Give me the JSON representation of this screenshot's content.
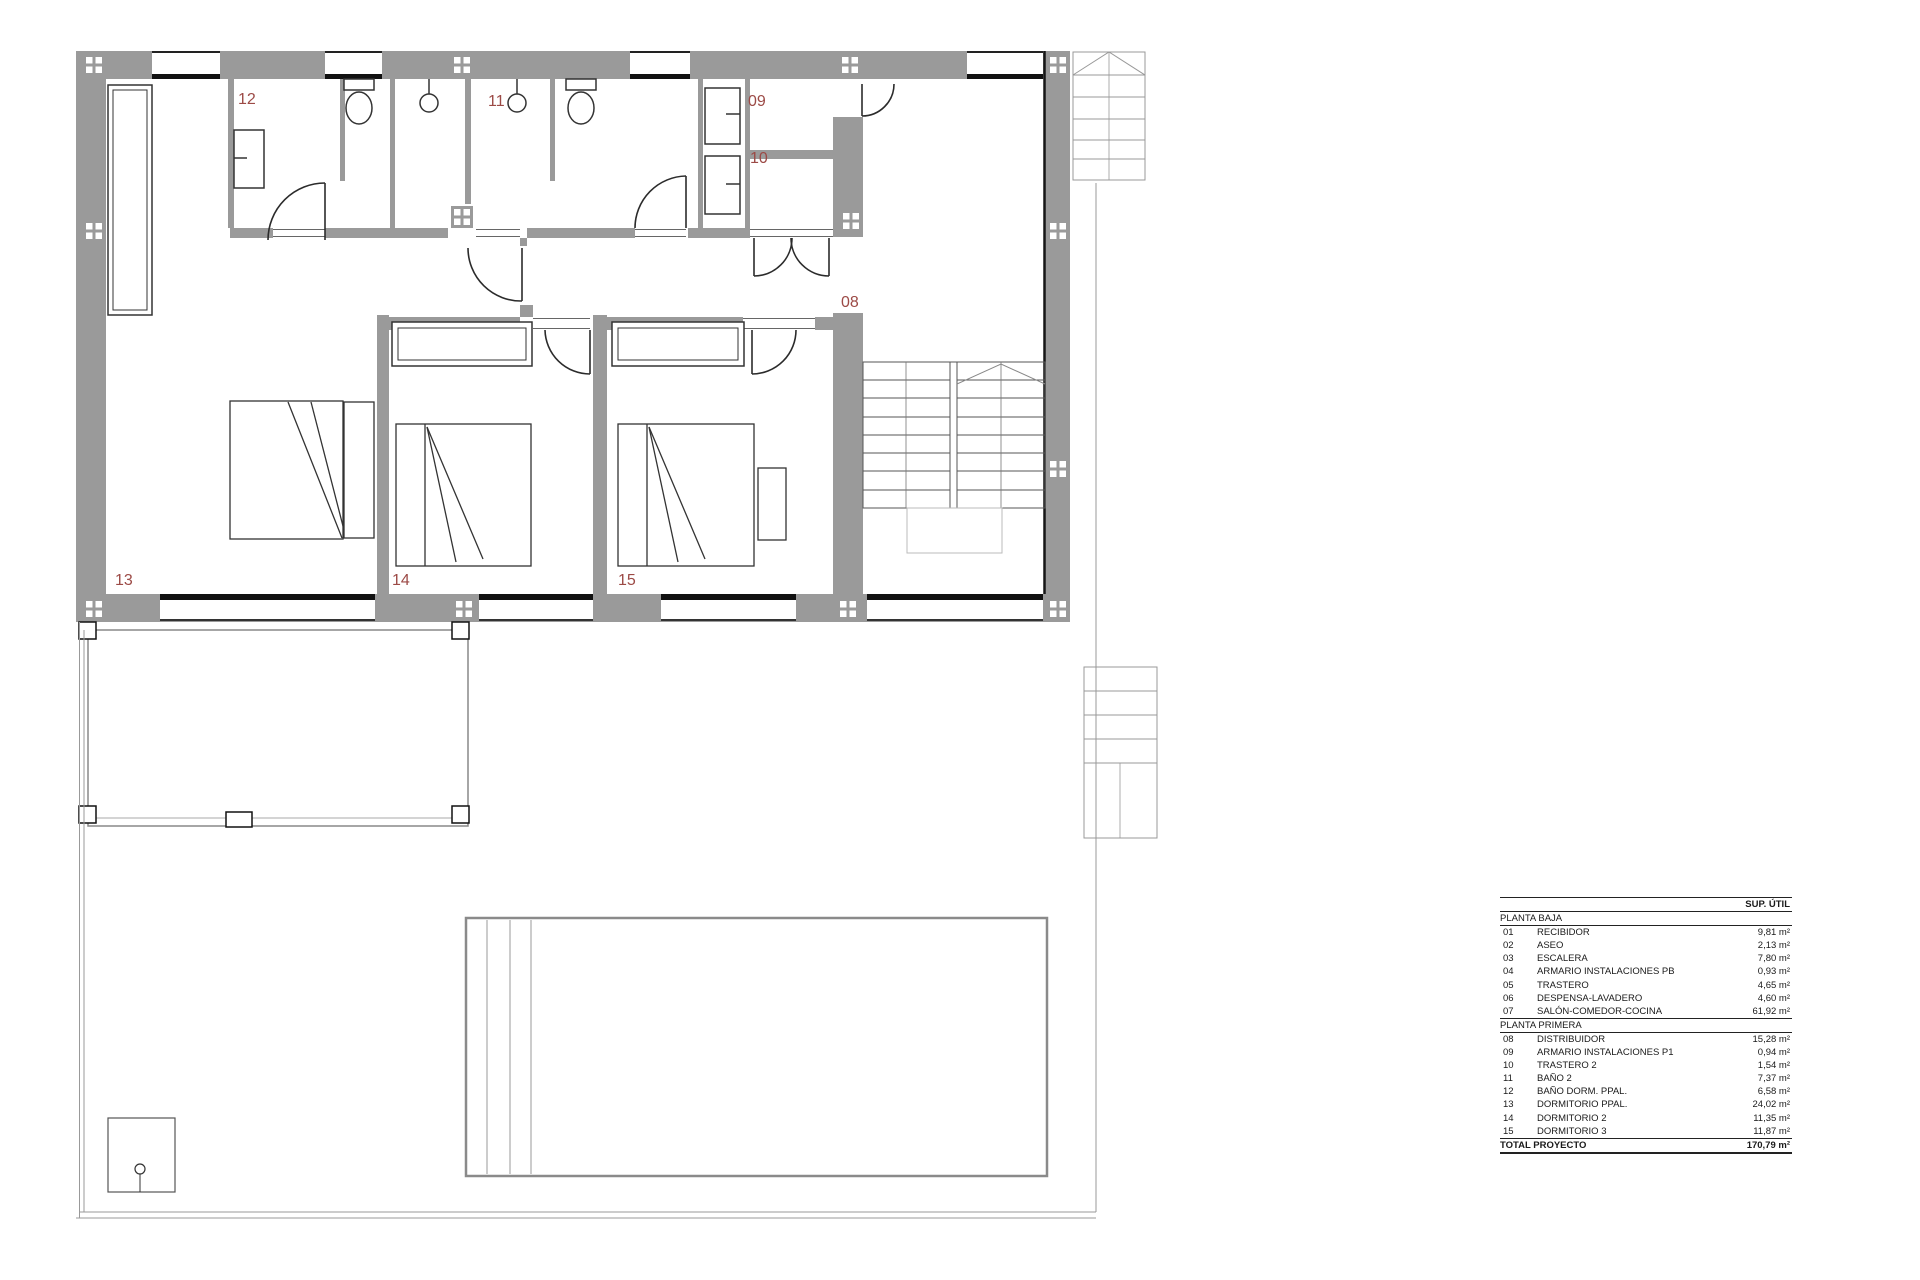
{
  "plan": {
    "room_labels": {
      "r08": "08",
      "r09": "09",
      "r10": "10",
      "r11": "11",
      "r12": "12",
      "r13": "13",
      "r14": "14",
      "r15": "15"
    },
    "colors": {
      "wall": "#9a9a9a",
      "label": "#9c4a46",
      "sill": "#111111"
    }
  },
  "area_table": {
    "col_header": "SUP. ÚTIL",
    "sections": [
      {
        "title": "PLANTA BAJA",
        "rows": [
          {
            "num": "01",
            "name": "RECIBIDOR",
            "area": "9,81 m²"
          },
          {
            "num": "02",
            "name": "ASEO",
            "area": "2,13 m²"
          },
          {
            "num": "03",
            "name": "ESCALERA",
            "area": "7,80 m²"
          },
          {
            "num": "04",
            "name": "ARMARIO INSTALACIONES PB",
            "area": "0,93 m²"
          },
          {
            "num": "05",
            "name": "TRASTERO",
            "area": "4,65 m²"
          },
          {
            "num": "06",
            "name": "DESPENSA-LAVADERO",
            "area": "4,60 m²"
          },
          {
            "num": "07",
            "name": "SALÓN-COMEDOR-COCINA",
            "area": "61,92 m²"
          }
        ]
      },
      {
        "title": "PLANTA PRIMERA",
        "rows": [
          {
            "num": "08",
            "name": "DISTRIBUIDOR",
            "area": "15,28 m²"
          },
          {
            "num": "09",
            "name": "ARMARIO INSTALACIONES P1",
            "area": "0,94 m²"
          },
          {
            "num": "10",
            "name": "TRASTERO 2",
            "area": "1,54 m²"
          },
          {
            "num": "11",
            "name": "BAÑO 2",
            "area": "7,37 m²"
          },
          {
            "num": "12",
            "name": "BAÑO DORM. PPAL.",
            "area": "6,58 m²"
          },
          {
            "num": "13",
            "name": "DORMITORIO PPAL.",
            "area": "24,02 m²"
          },
          {
            "num": "14",
            "name": "DORMITORIO 2",
            "area": "11,35 m²"
          },
          {
            "num": "15",
            "name": "DORMITORIO 3",
            "area": "11,87 m²"
          }
        ]
      }
    ],
    "total": {
      "label": "TOTAL PROYECTO",
      "area": "170,79 m²"
    }
  }
}
